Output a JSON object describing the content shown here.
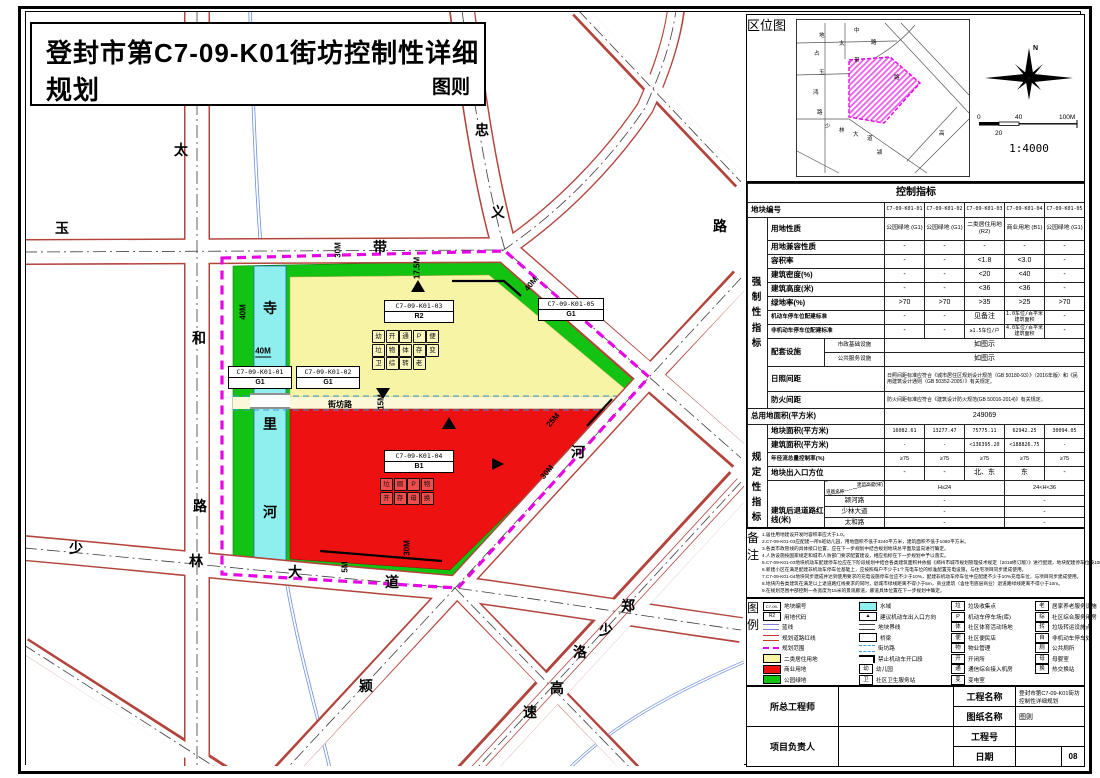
{
  "sheet": {
    "page_no": "08"
  },
  "title": {
    "main": "登封市第C7-09-K01街坊控制性详细规划",
    "sub": "图则"
  },
  "location": {
    "label_chars": "区位图",
    "north": "N",
    "scale_ticks": {
      "zero": "0",
      "forty": "40",
      "hundred": "100M",
      "mid": "20"
    },
    "ratio": "1:4000",
    "minimap_labels": [
      {
        "t": "地",
        "x": 22,
        "y": 14
      },
      {
        "t": "占",
        "x": 17,
        "y": 32
      },
      {
        "t": "玉",
        "x": 22,
        "y": 51
      },
      {
        "t": "鸿",
        "x": 16,
        "y": 71
      },
      {
        "t": "路",
        "x": 20,
        "y": 91
      },
      {
        "t": "太",
        "x": 42,
        "y": 22
      },
      {
        "t": "中",
        "x": 57,
        "y": 9
      },
      {
        "t": "带",
        "x": 57,
        "y": 39
      },
      {
        "t": "路",
        "x": 74,
        "y": 21
      },
      {
        "t": "路",
        "x": 97,
        "y": 56
      },
      {
        "t": "少",
        "x": 28,
        "y": 105
      },
      {
        "t": "林",
        "x": 42,
        "y": 109
      },
      {
        "t": "大",
        "x": 56,
        "y": 113
      },
      {
        "t": "道",
        "x": 70,
        "y": 117
      },
      {
        "t": "颍",
        "x": 80,
        "y": 131
      },
      {
        "t": "高",
        "x": 142,
        "y": 112
      }
    ]
  },
  "map": {
    "street_labels": [
      {
        "t": "太",
        "x": 181,
        "y": 150
      },
      {
        "t": "和",
        "x": 199,
        "y": 338
      },
      {
        "t": "路",
        "x": 200,
        "y": 506
      },
      {
        "t": "玉",
        "x": 62,
        "y": 228
      },
      {
        "t": "带",
        "x": 380,
        "y": 247
      },
      {
        "t": "忠",
        "x": 482,
        "y": 130
      },
      {
        "t": "义",
        "x": 498,
        "y": 212
      },
      {
        "t": "路",
        "x": 588,
        "y": 308
      },
      {
        "t": "路",
        "x": 720,
        "y": 226
      },
      {
        "t": "少",
        "x": 76,
        "y": 548
      },
      {
        "t": "林",
        "x": 196,
        "y": 561
      },
      {
        "t": "大",
        "x": 295,
        "y": 572
      },
      {
        "t": "道",
        "x": 392,
        "y": 582
      },
      {
        "t": "颍",
        "x": 366,
        "y": 686
      },
      {
        "t": "河",
        "x": 578,
        "y": 452
      },
      {
        "t": "郑",
        "x": 628,
        "y": 606
      },
      {
        "t": "少",
        "x": 606,
        "y": 630
      },
      {
        "t": "洛",
        "x": 580,
        "y": 652
      },
      {
        "t": "高",
        "x": 557,
        "y": 688
      },
      {
        "t": "速",
        "x": 530,
        "y": 712
      },
      {
        "t": "寺",
        "x": 270,
        "y": 308
      },
      {
        "t": "里",
        "x": 270,
        "y": 424
      },
      {
        "t": "河",
        "x": 270,
        "y": 512
      }
    ],
    "dim_labels": [
      {
        "t": "40M",
        "x": 243,
        "y": 312,
        "r": -90
      },
      {
        "t": "40M",
        "x": 263,
        "y": 352,
        "r": 0,
        "u": true
      },
      {
        "t": "30M",
        "x": 338,
        "y": 250,
        "r": -90
      },
      {
        "t": "17.5M",
        "x": 417,
        "y": 268,
        "r": -90
      },
      {
        "t": "40M",
        "x": 531,
        "y": 284,
        "r": -50
      },
      {
        "t": "25M",
        "x": 553,
        "y": 420,
        "r": -50
      },
      {
        "t": "30M",
        "x": 547,
        "y": 472,
        "r": -50
      },
      {
        "t": "30M",
        "x": 407,
        "y": 548,
        "r": -90
      },
      {
        "t": "5M",
        "x": 345,
        "y": 567,
        "r": -90
      },
      {
        "t": "15M",
        "x": 381,
        "y": 402,
        "r": -90
      }
    ],
    "street_inner": "街坊路",
    "parcels": [
      {
        "code": "C7-09-K01-01",
        "use": "G1",
        "x": 228,
        "y": 366,
        "w": 62
      },
      {
        "code": "C7-09-K01-02",
        "use": "G1",
        "x": 296,
        "y": 366,
        "w": 62
      },
      {
        "code": "C7-09-K01-03",
        "use": "R2",
        "x": 384,
        "y": 300,
        "w": 68
      },
      {
        "code": "C7-09-K01-04",
        "use": "B1",
        "x": 384,
        "y": 450,
        "w": 68
      },
      {
        "code": "C7-09-K01-05",
        "use": "G1",
        "x": 538,
        "y": 298,
        "w": 64
      }
    ],
    "icon_grids": [
      {
        "x": 372,
        "y": 330,
        "rows": [
          [
            "幼",
            "开",
            "通",
            "P",
            "便"
          ],
          [
            "垃",
            "物",
            "体",
            "存",
            "变"
          ],
          [
            "卫",
            "综",
            "转",
            "老"
          ]
        ]
      },
      {
        "x": 380,
        "y": 478,
        "rows": [
          [
            "垃",
            "厕",
            "P",
            "物"
          ],
          [
            "开",
            "存",
            "母",
            "换"
          ]
        ]
      }
    ]
  },
  "table": {
    "title": "控制指标",
    "id_label": "地块编号",
    "ids": [
      "C7-09-K01-01",
      "C7-09-K01-02",
      "C7-09-K01-03",
      "C7-09-K01-04",
      "C7-09-K01-05"
    ],
    "group1_label": "强制性指标",
    "group2_label": "规定性指标",
    "rows1": [
      {
        "label": "用地性质",
        "cells": [
          "公园绿地 (G1)",
          "公园绿地 (G1)",
          "二类居住用地 (R2)",
          "商业用地 (B1)",
          "公园绿地 (G1)"
        ],
        "use": true
      },
      {
        "label": "用地兼容性质",
        "cells": [
          "-",
          "-",
          "-",
          "-",
          "-"
        ]
      },
      {
        "label": "容积率",
        "cells": [
          "-",
          "-",
          "<1.8",
          "<3.0",
          "-"
        ]
      },
      {
        "label": "建筑密度(%)",
        "cells": [
          "-",
          "-",
          "<20",
          "<40",
          "-"
        ]
      },
      {
        "label": "建筑高度(米)",
        "cells": [
          "-",
          "-",
          "<36",
          "<36",
          "-"
        ]
      },
      {
        "label": "绿地率(%)",
        "cells": [
          ">70",
          ">70",
          ">35",
          ">25",
          ">70"
        ]
      },
      {
        "label": "机动车停车位配建标准",
        "cells": [
          "-",
          "-",
          "见备注",
          "1.0车位/百平米建筑面积",
          "-"
        ],
        "small": true
      },
      {
        "label": "非机动车停车位配建标准",
        "cells": [
          "-",
          "-",
          "≥1.5车位/户",
          "4.0车位/百平米建筑面积",
          "-"
        ],
        "small": true
      }
    ],
    "supporting": {
      "label": "配套设施",
      "subs": [
        {
          "name": "市政基础设施",
          "value": "如图示"
        },
        {
          "name": "公共服务设施",
          "value": "如图示"
        }
      ]
    },
    "sunlight": {
      "label": "日照间距",
      "value": "日照间距标准应符合《城市居住区规划设计规范（GB 50180-93）》（2016年版）和《民用建筑设计通则（GB 50352-2005）》有关规定。"
    },
    "fire": {
      "label": "防火间距",
      "value": "防火间距标准应符合《建筑设计防火规范(GB 50016-2014)》有关规定。"
    },
    "total_area": {
      "label": "总用地面积(平方米)",
      "value": "249069"
    },
    "rows2": [
      {
        "label": "地块面积(平方米)",
        "cells": [
          "16082.61",
          "13277.47",
          "75775.11",
          "62942.25",
          "30094.05"
        ],
        "mono": true
      },
      {
        "label": "建筑面积(平方米)",
        "cells": [
          "-",
          "-",
          "<136395.20",
          "<188826.75",
          "-"
        ],
        "mono": true
      },
      {
        "label": "年径流总量控制率(%)",
        "cells": [
          "≥75",
          "≥75",
          "≥75",
          "≥75",
          "≥75"
        ],
        "small": true
      },
      {
        "label": "地块出入口方位",
        "cells": [
          "-",
          "-",
          "北、东",
          "东",
          "-"
        ]
      }
    ],
    "setback": {
      "label": "建筑后退道路红线(米)",
      "corner_top": "建筑高度(米)",
      "corner_bottom": "道路名称",
      "col_headers": [
        "H≤24",
        "24<H<36"
      ],
      "roads": [
        {
          "name": "颍河路",
          "v": [
            "-",
            "-"
          ]
        },
        {
          "name": "少林大道",
          "v": [
            "-",
            "-"
          ]
        },
        {
          "name": "太和路",
          "v": [
            "-",
            "-"
          ]
        },
        {
          "name": "玉带路",
          "v": [
            "-",
            "-"
          ]
        },
        {
          "name": "忠义路",
          "v": [
            "-",
            "-"
          ]
        }
      ]
    },
    "capacity": {
      "label": "人口容量(人)",
      "cells": [
        "-",
        "-",
        "3897",
        "-",
        "-"
      ]
    }
  },
  "notes": {
    "label": "备注",
    "lines": [
      "1.居住用地建设开发时容积率应大于1.0。",
      "2.C7-09-K01-03应配建一所6班幼儿园，用地面积不低于3240平方米，建筑面积不低于1080平方米。",
      "3.各类市政管线的具体接口位置，应在下一步规划中结合规划地块总平面及竖向进行确定。",
      "4.人防设施按国家规定和城市人防部门要求配置建设，相应指标在下一步规划中予以落实。",
      "5.C7-09-K01-03地块机动车配建停车位应在下阶段规划中结合各类建筑面积并依据《郑州市城市规划管理技术规定（2018修订版）》进行配建，地块配建停车位按100%建设充电设施或预留安装条件。其中，不少于10%的车位应与住宅项目同步建成充电设施，达到同步使用要求。",
      "6.新建小区在满足配建非机动车停车位基础上，应按照每户不少于1个充电车位的标准配置充电设施，与住宅项目同步建成使用。",
      "7.C7-09-K01-04地块同步建成并达到使用要求的充电设施停车位应不少于10%，配建非机动车停车位中应配建不少于10%充电车位，与项目同步建成使用。",
      "8.地块内各类建筑在满足以上退道路红线要求的同时，退城市绿线距离不得小于5m，商业建筑（含住宅底层商业）退道路绿线距离不得小于10m。",
      "9.在规划范围中部控制一条宽度为15米的景观廊道，廊道具体位置在下一步规划中确定。"
    ]
  },
  "legend": {
    "label": "图例",
    "columns": [
      [
        {
          "sym": "parcel-code",
          "glyph": "C7-09-K01-01",
          "label": "地块编号"
        },
        {
          "sym": "use-code",
          "glyph": "R2",
          "label": "用地代码"
        },
        {
          "sym": "blue-line",
          "label": "蓝线"
        },
        {
          "sym": "road-redline",
          "label": "规划道路红线"
        },
        {
          "sym": "plan-boundary",
          "label": "规划范围"
        },
        {
          "sym": "swatch-yellow",
          "label": "二类居住用地"
        },
        {
          "sym": "swatch-red",
          "label": "商业用地"
        },
        {
          "sym": "swatch-green",
          "label": "公园绿地"
        }
      ],
      [
        {
          "sym": "swatch-cyan",
          "label": "水域"
        },
        {
          "sym": "entry-arrow",
          "glyph": "▲",
          "label": "建议机动车出入口方向"
        },
        {
          "sym": "parcel-line",
          "label": "地块界线"
        },
        {
          "sym": "bridge",
          "label": "桥梁"
        },
        {
          "sym": "lane-dash",
          "label": "街坊路"
        },
        {
          "sym": "no-entry",
          "label": "禁止机动车开口段"
        },
        {
          "sym": "box-glyph",
          "glyph": "幼",
          "label": "幼儿园"
        },
        {
          "sym": "box-glyph",
          "glyph": "卫",
          "label": "社区卫生服务站"
        }
      ],
      [
        {
          "sym": "box-glyph",
          "glyph": "垃",
          "label": "垃圾收集点"
        },
        {
          "sym": "box-glyph",
          "glyph": "P",
          "label": "机动车停车场(库)"
        },
        {
          "sym": "box-glyph",
          "glyph": "体",
          "label": "社区体育活动场地"
        },
        {
          "sym": "box-glyph",
          "glyph": "便",
          "label": "社区便民店"
        },
        {
          "sym": "box-glyph",
          "glyph": "物",
          "label": "物业管理"
        },
        {
          "sym": "box-glyph",
          "glyph": "开",
          "label": "开闭所"
        },
        {
          "sym": "box-glyph",
          "glyph": "通",
          "label": "通信综合接入机房"
        },
        {
          "sym": "box-glyph",
          "glyph": "变",
          "label": "变电室"
        }
      ],
      [
        {
          "sym": "box-glyph",
          "glyph": "老",
          "label": "居家养老服务设施"
        },
        {
          "sym": "box-glyph",
          "glyph": "综",
          "label": "社区综合服务用房"
        },
        {
          "sym": "box-glyph",
          "glyph": "转",
          "label": "垃圾转运设施点"
        },
        {
          "sym": "box-glyph",
          "glyph": "自",
          "label": "非机动车停车处"
        },
        {
          "sym": "box-glyph",
          "glyph": "厕",
          "label": "公共厕所"
        },
        {
          "sym": "box-glyph",
          "glyph": "母",
          "label": "母婴室"
        },
        {
          "sym": "box-glyph",
          "glyph": "换",
          "label": "热交换站"
        }
      ]
    ]
  },
  "title_block": {
    "chief_engineer": "所总工程师",
    "project_lead": "项目负责人",
    "project_name_label": "工程名称",
    "project_name": "登封市第C7-09-K01街坊控制性详细规划",
    "drawing_name_label": "图纸名称",
    "drawing_name": "图则",
    "project_no_label": "工程号",
    "project_no": "",
    "date_label": "日期",
    "date": "",
    "page": "08"
  },
  "colors": {
    "green": "#12c312",
    "yellow": "#f7f4a6",
    "red": "#ee1111",
    "cyan": "#8feeee",
    "magenta": "#e604e6",
    "road_edge": "#b2443c",
    "lane_blue": "#3f9ae0"
  }
}
